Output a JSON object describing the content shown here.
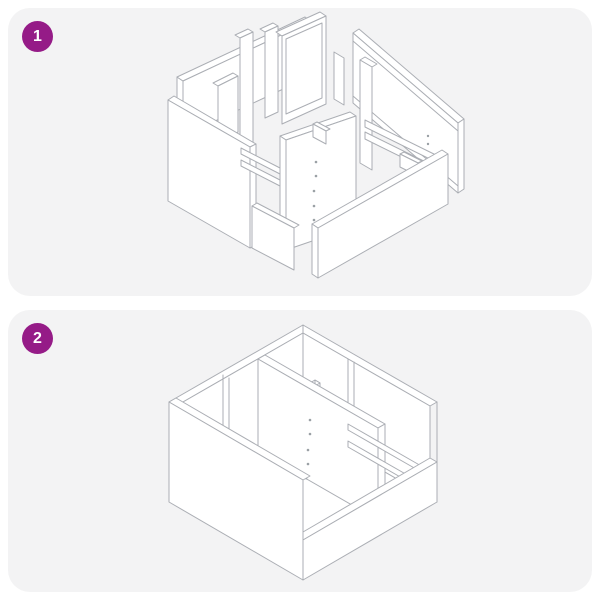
{
  "document": {
    "type": "assembly-instruction-sheet",
    "page_background": "#ffffff"
  },
  "steps": [
    {
      "number": "1",
      "diagram": "exploded-cabinet-parts-isometric-diagram"
    },
    {
      "number": "2",
      "diagram": "assembled-cabinet-open-top-isometric-diagram"
    }
  ],
  "colors": {
    "panel_background": "#f3f3f4",
    "badge_background": "#951b87",
    "badge_text": "#ffffff",
    "drawing_line": "#abaeb4",
    "drawing_face": "#ffffff"
  }
}
